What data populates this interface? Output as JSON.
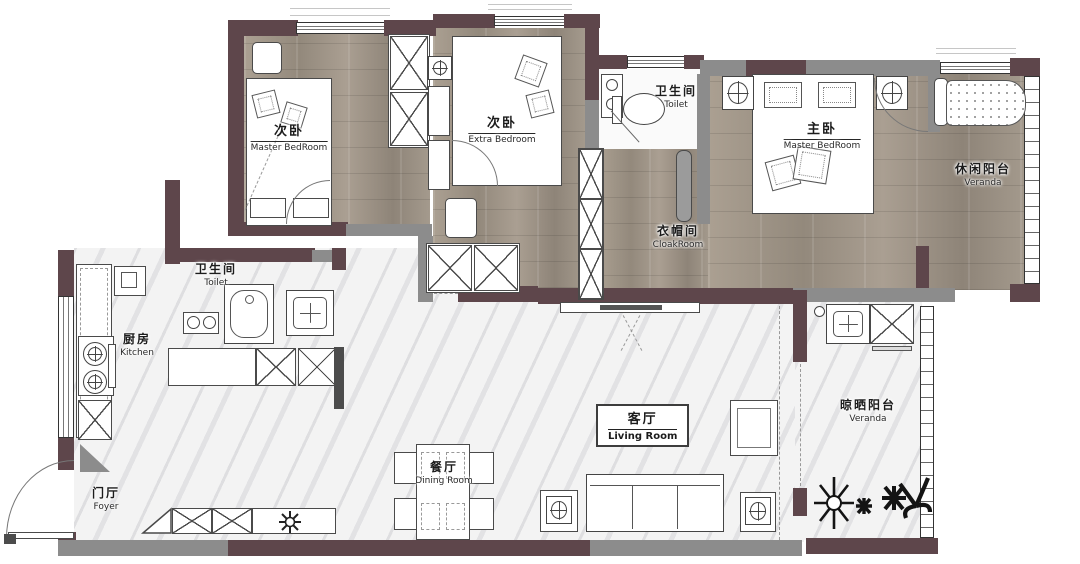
{
  "plan": {
    "title": "apartment floor plan",
    "rooms": {
      "bedroom_left": {
        "zh": "次卧",
        "en": "Master BedRoom"
      },
      "bedroom_mid": {
        "zh": "次卧",
        "en": "Extra Bedroom"
      },
      "toilet_top": {
        "zh": "卫生间",
        "en": "Toilet"
      },
      "master_bedroom": {
        "zh": "主卧",
        "en": "Master BedRoom"
      },
      "veranda_right": {
        "zh": "休闲阳台",
        "en": "Veranda"
      },
      "cloakroom": {
        "zh": "衣帽间",
        "en": "CloakRoom"
      },
      "toilet_left": {
        "zh": "卫生间",
        "en": "Toilet"
      },
      "kitchen": {
        "zh": "厨房",
        "en": "Kitchen"
      },
      "living": {
        "zh": "客厅",
        "en": "Living Room"
      },
      "dining": {
        "zh": "餐厅",
        "en": "Dining Room"
      },
      "veranda_bottom": {
        "zh": "晾晒阳台",
        "en": "Veranda"
      },
      "foyer": {
        "zh": "门厅",
        "en": "Foyer"
      }
    },
    "colors": {
      "exterior_wall": "#5e464b",
      "partition_wall": "#8c8c8c",
      "wood_floor": "#a1968a",
      "marble_floor": "#f3f3f3",
      "drawing_line": "#4a4a4a"
    }
  }
}
